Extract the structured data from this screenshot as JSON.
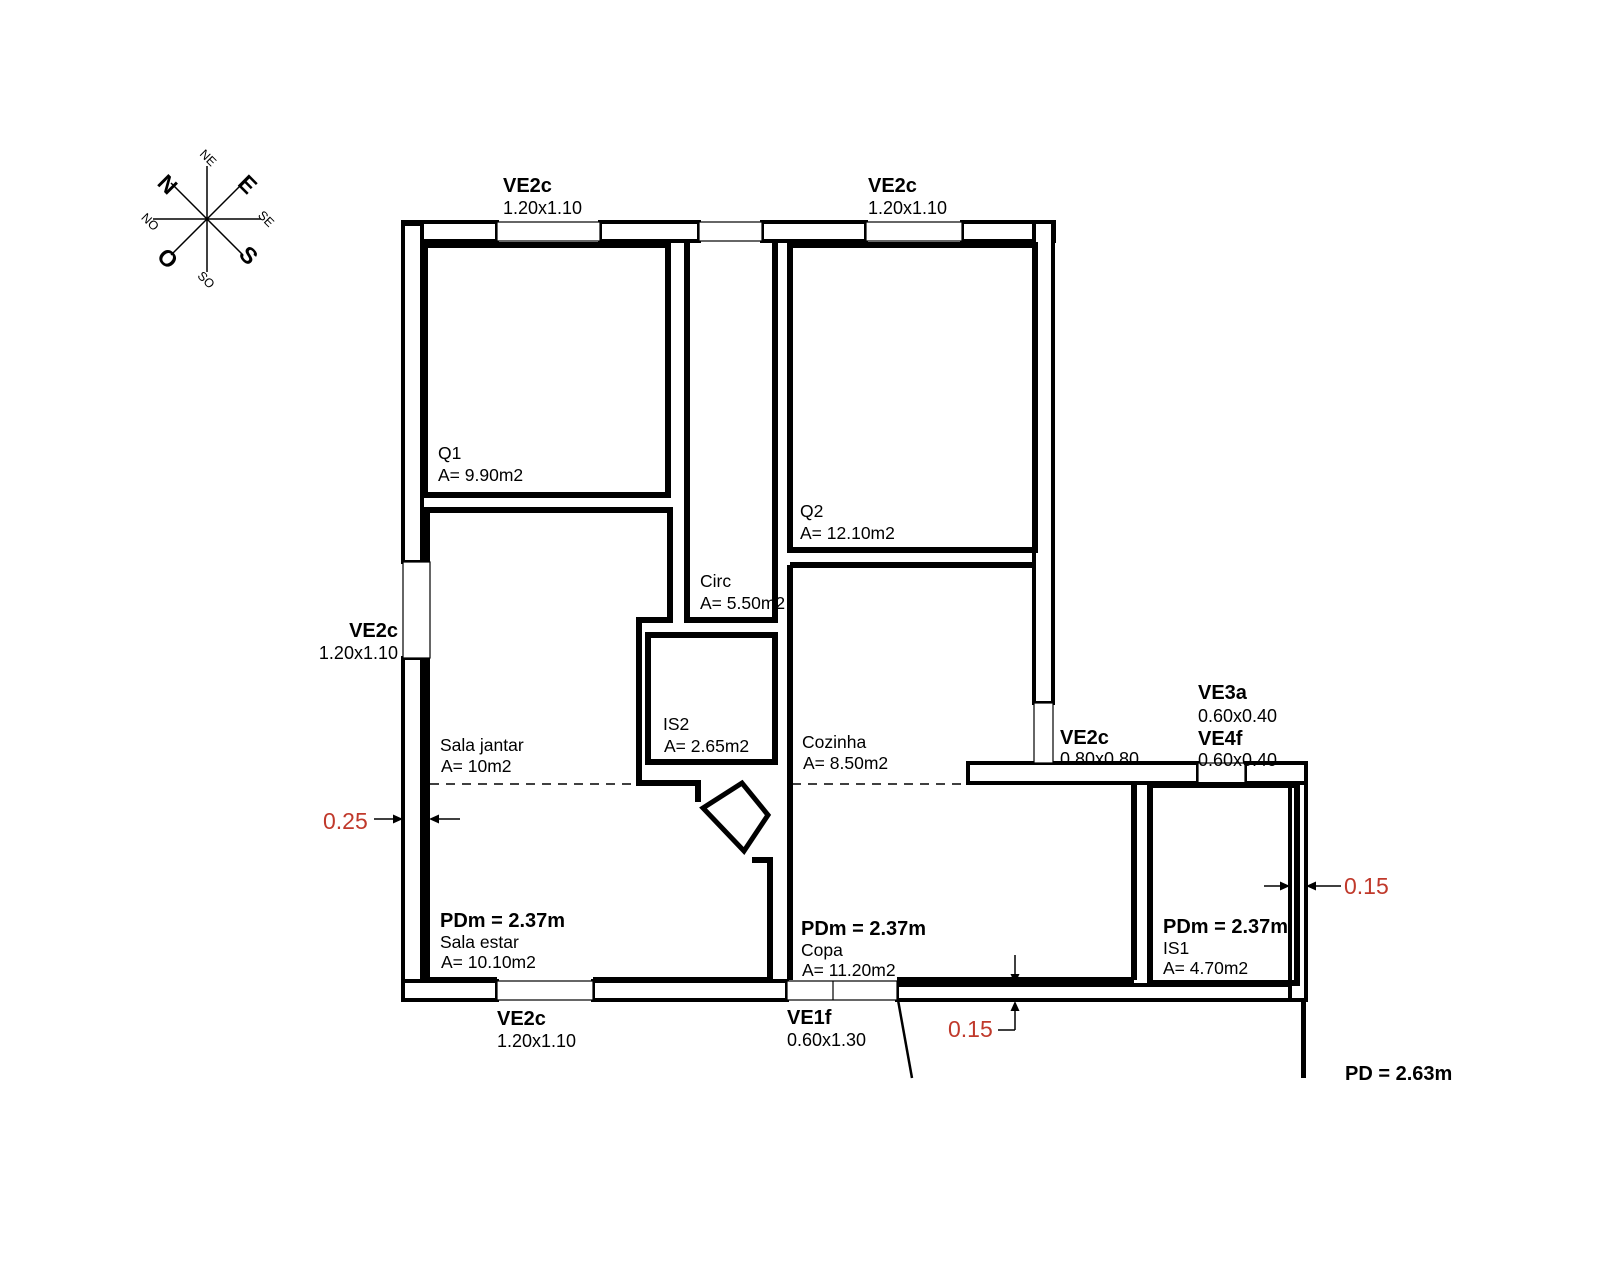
{
  "compass": {
    "n": "N",
    "e": "E",
    "s": "S",
    "o": "O",
    "ne": "NE",
    "se": "SE",
    "so": "SO",
    "no": "NO"
  },
  "windows": {
    "top1": {
      "code": "VE2c",
      "size": "1.20x1.10"
    },
    "top2": {
      "code": "VE2c",
      "size": "1.20x1.10"
    },
    "left": {
      "code": "VE2c",
      "size": "1.20x1.10"
    },
    "bottom": {
      "code": "VE2c",
      "size": "1.20x1.10"
    },
    "ve1f": {
      "code": "VE1f",
      "size": "0.60x1.30"
    },
    "east": {
      "code": "VE2c",
      "size": "0.80x0.80"
    },
    "ve3a": {
      "code": "VE3a",
      "size": "0.60x0.40"
    },
    "ve4f": {
      "code": "VE4f",
      "size": "0.60x0.40"
    }
  },
  "rooms": {
    "q1": {
      "name": "Q1",
      "area": "A= 9.90m2"
    },
    "q2": {
      "name": "Q2",
      "area": "A= 12.10m2"
    },
    "circ": {
      "name": "Circ",
      "area": "A= 5.50m2"
    },
    "is2": {
      "name": "IS2",
      "area": "A= 2.65m2"
    },
    "cozinha": {
      "name": "Cozinha",
      "area": "A= 8.50m2"
    },
    "sala_jantar": {
      "name": "Sala jantar",
      "area": "A= 10m2"
    },
    "sala_estar": {
      "name": "Sala estar",
      "area": "A= 10.10m2",
      "pdm": "PDm = 2.37m"
    },
    "copa": {
      "name": "Copa",
      "area": "A= 11.20m2",
      "pdm": "PDm = 2.37m"
    },
    "is1": {
      "name": "IS1",
      "area": "A= 4.70m2",
      "pdm": "PDm = 2.37m"
    }
  },
  "dimensions": {
    "left_wall": "0.25",
    "bottom_wall": "0.15",
    "right_wall": "0.15"
  },
  "ceiling": {
    "pd": "PD = 2.63m"
  },
  "colors": {
    "dimension_red": "#c0392b",
    "line_black": "#000000",
    "background": "#ffffff"
  }
}
